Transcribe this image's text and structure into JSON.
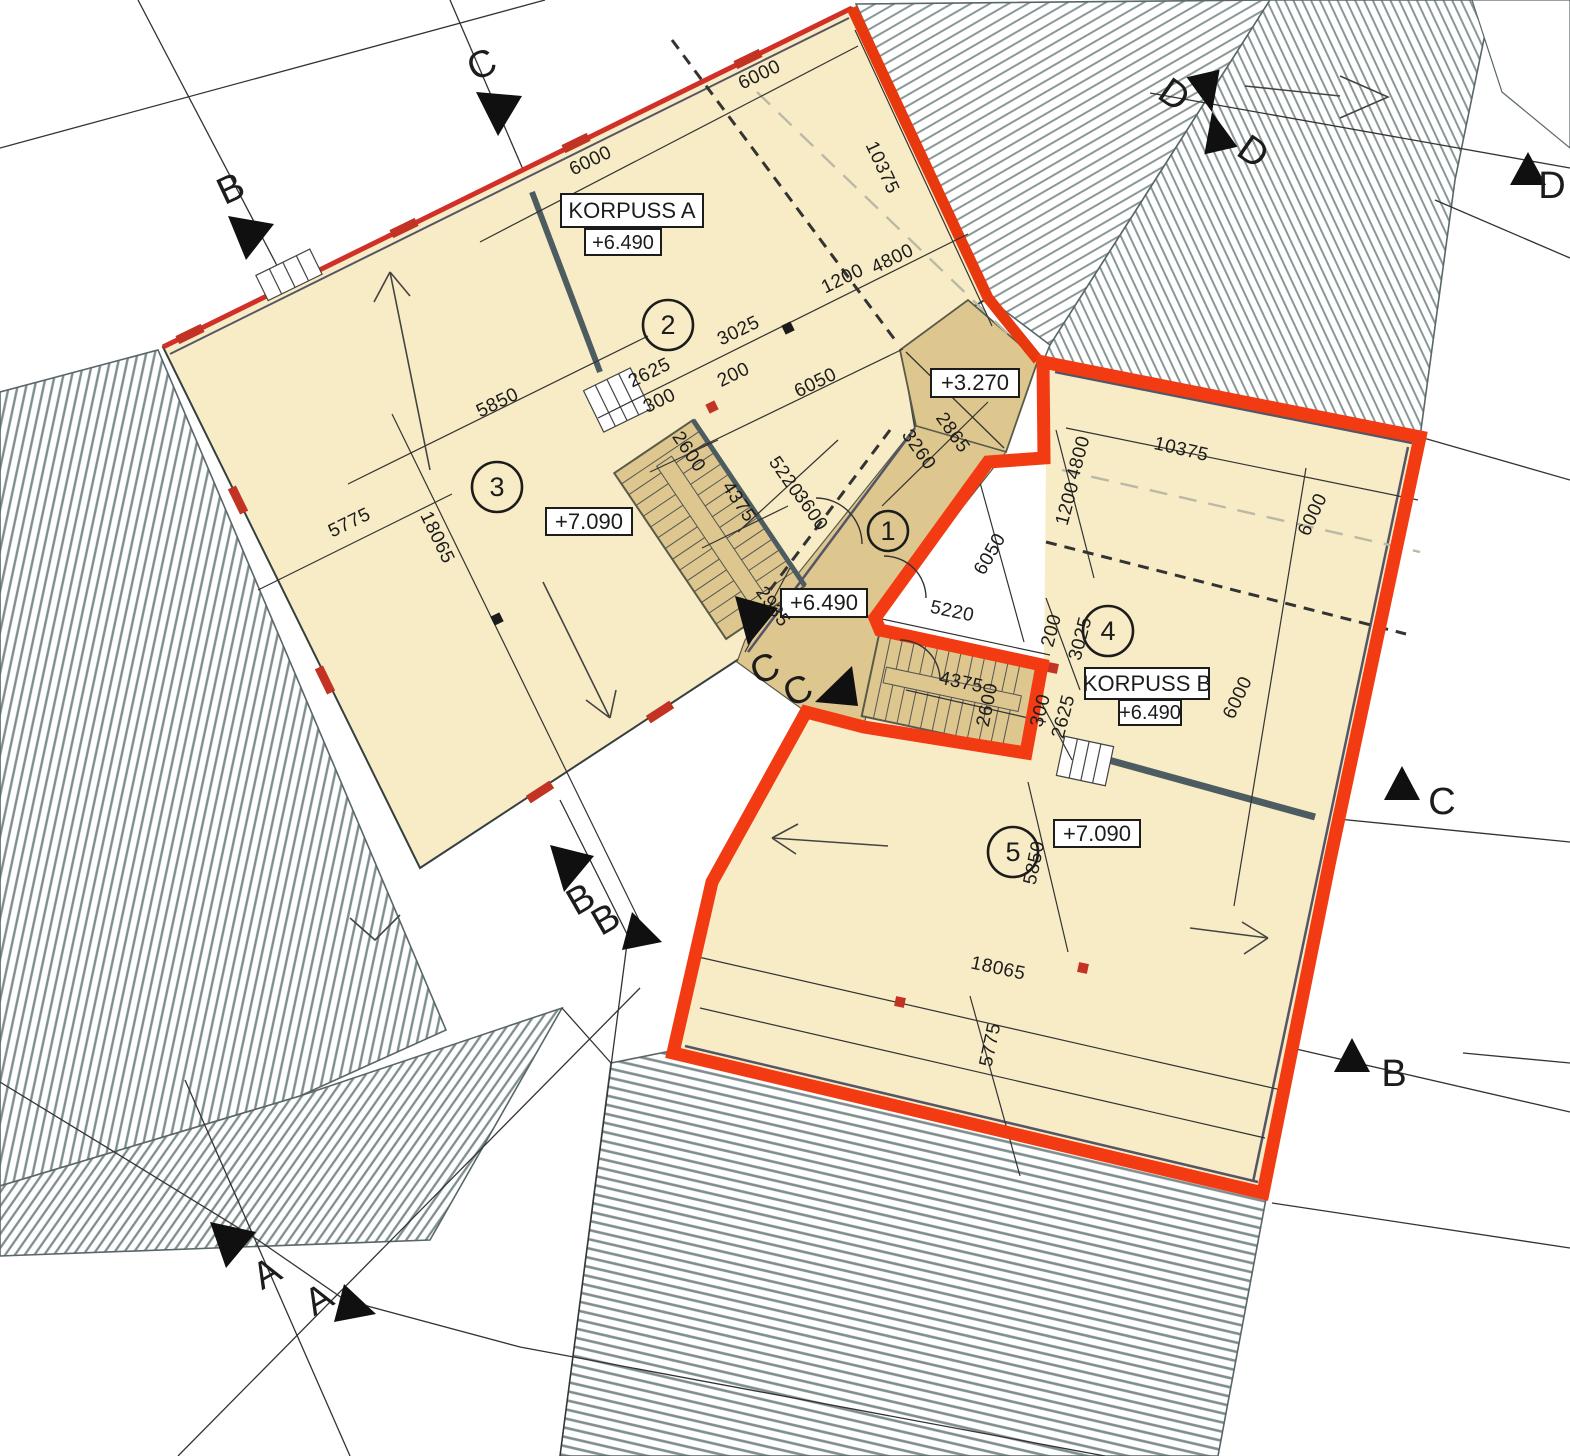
{
  "colors": {
    "cream": "#F8ECC6",
    "tan": "#DDC78E",
    "scope_red": "#F23B12",
    "accent_red": "#C23324",
    "roof_stripe": "#7E8D8D",
    "wall_gray": "#4D5C60"
  },
  "buildings": {
    "a": {
      "label": "KORPUSS A",
      "elev": "+6.490"
    },
    "b": {
      "label": "KORPUSS B",
      "elev": "+6.490"
    }
  },
  "levels": {
    "hall": "+6.490",
    "plaza": "+3.270",
    "a_upper": "+7.090",
    "b_upper": "+7.090"
  },
  "zones": [
    "1",
    "2",
    "3",
    "4",
    "5"
  ],
  "sections": {
    "c_top": "C",
    "b_top": "B",
    "d1": "D",
    "d2": "D",
    "d_right": "D",
    "cc1": "C",
    "cc2": "C",
    "bb1": "B",
    "bb2": "B",
    "c_right": "C",
    "b_right": "B",
    "a1": "A",
    "a2": "A"
  },
  "dims": {
    "a_6000_1": "6000",
    "a_6000_2": "6000",
    "a_10375": "10375",
    "a_1200": "1200",
    "a_4800": "4800",
    "a_3025": "3025",
    "a_200": "200",
    "a_2625": "2625",
    "a_300": "300",
    "a_5850": "5850",
    "a_5775": "5775",
    "a_18065": "18065",
    "a_6050": "6050",
    "h_2600": "2600",
    "h_4375": "4375",
    "h_5220": "5220",
    "h_3600": "3600",
    "h_2935": "2935",
    "h_3260": "3260",
    "h_2865": "2865",
    "b_10375": "10375",
    "b_4800": "4800",
    "b_1200": "1200",
    "b_6000_1": "6000",
    "b_6000_2": "6000",
    "b_6050": "6050",
    "b_5220": "5220",
    "b_200": "200",
    "b_3025": "3025",
    "b_4375": "4375",
    "b_2600": "2600",
    "b_300": "300",
    "b_2625": "2625",
    "b_5850": "5850",
    "b_18065": "18065",
    "b_5775": "5775"
  }
}
